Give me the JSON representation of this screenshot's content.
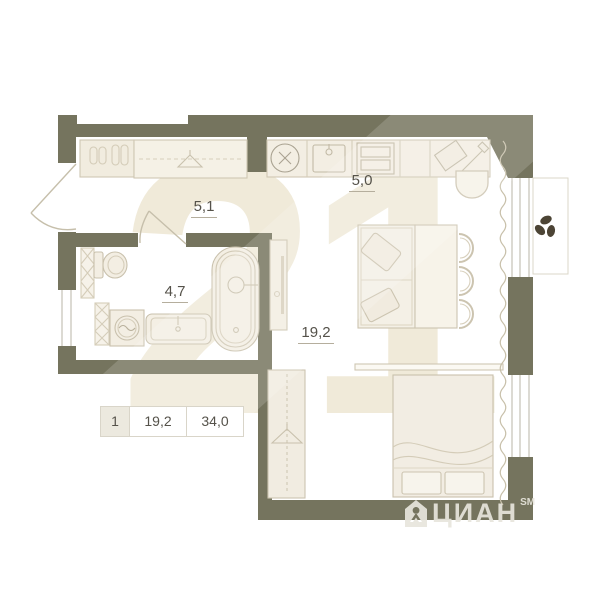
{
  "plan": {
    "rooms": [
      {
        "name": "hallway",
        "area": "5,1"
      },
      {
        "name": "kitchen",
        "area": "5,0"
      },
      {
        "name": "bathroom",
        "area": "4,7"
      },
      {
        "name": "living-room",
        "area": "19,2"
      }
    ],
    "summary_table": {
      "rooms_count": "1",
      "living_area": "19,2",
      "total_area": "34,0"
    },
    "colors": {
      "wall": "#75745e",
      "furniture_fill": "#f3eee3",
      "furniture_outline": "#ccc4b0",
      "label_text": "#55524a",
      "watermark_beige": "#f0ead9",
      "plant_leaves": "#4c4435"
    },
    "icons": {
      "hanger-icon": "clothes hanger",
      "slippers-icon": "two pairs of slippers",
      "appliance-x-icon": "circle with X",
      "washer-drum-icon": "circle with wave",
      "sink-icon": "basin with tap",
      "stove-icon": "hob with burners",
      "cutting-board-icon": "board with knife",
      "plant-icon": "three leaves",
      "house-icon": "brand house pictogram"
    }
  },
  "watermark": {
    "logo_text": "21",
    "brand_text": "ЦИАН",
    "brand_suffix": "SM"
  }
}
